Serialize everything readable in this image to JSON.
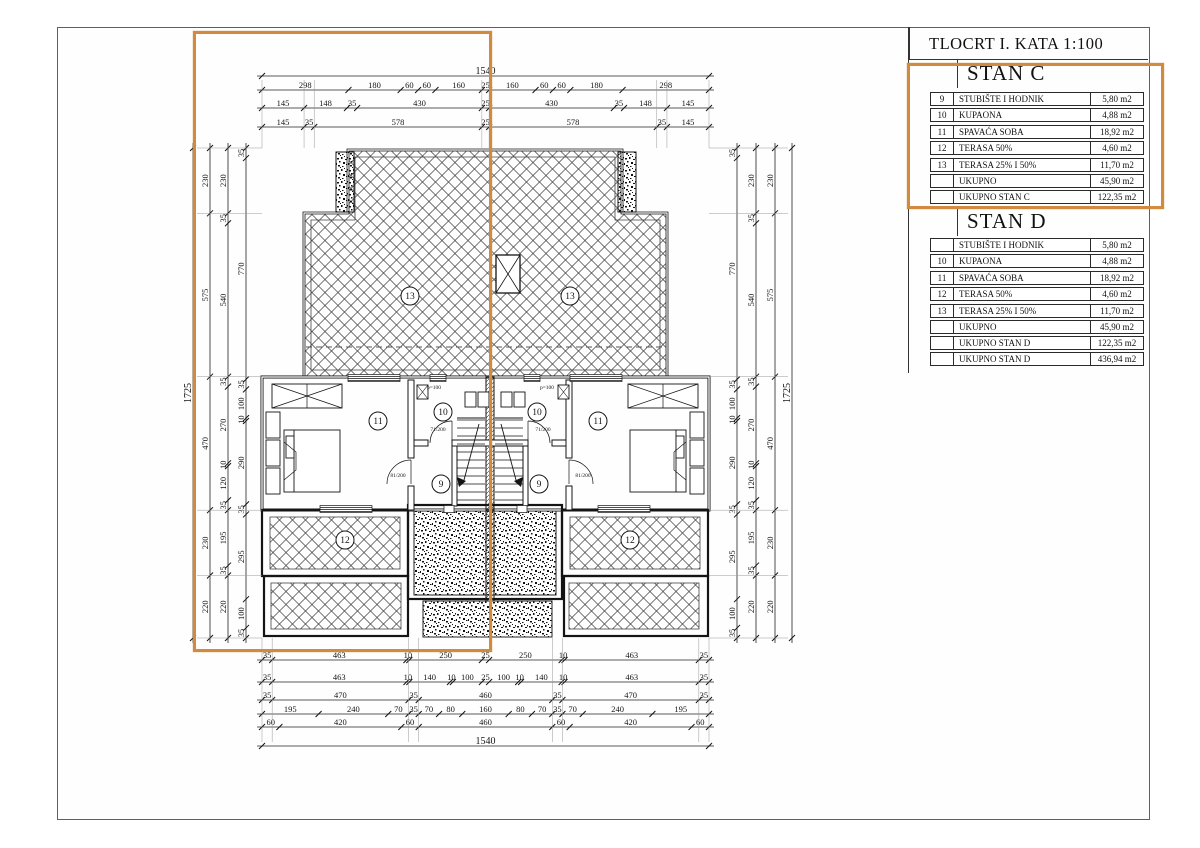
{
  "title": "TLOCRT I. KATA 1:100",
  "highlight_color": "#d28a3e",
  "tables": {
    "stan_c": {
      "title": "STAN C",
      "rows": [
        [
          "9",
          "STUBIŠTE I HODNIK",
          "5,80 m2"
        ],
        [
          "10",
          "KUPAONA",
          "4,88 m2"
        ],
        [
          "11",
          "SPAVAĆA SOBA",
          "18,92 m2"
        ],
        [
          "12",
          "TERASA 50%",
          "4,60 m2"
        ],
        [
          "13",
          "TERASA 25% I 50%",
          "11,70 m2"
        ],
        [
          "",
          "UKUPNO",
          "45,90 m2"
        ],
        [
          "",
          "UKUPNO STAN C",
          "122,35 m2"
        ]
      ]
    },
    "stan_d": {
      "title": "STAN D",
      "rows": [
        [
          "",
          "STUBIŠTE I HODNIK",
          "5,80 m2"
        ],
        [
          "10",
          "KUPAONA",
          "4,88 m2"
        ],
        [
          "11",
          "SPAVAĆA SOBA",
          "18,92 m2"
        ],
        [
          "12",
          "TERASA 50%",
          "4,60 m2"
        ],
        [
          "13",
          "TERASA 25% I 50%",
          "11,70 m2"
        ],
        [
          "",
          "UKUPNO",
          "45,90 m2"
        ],
        [
          "",
          "UKUPNO STAN D",
          "122,35 m2"
        ]
      ]
    },
    "total": {
      "rows": [
        [
          "",
          "UKUPNO STAN D",
          "436,94 m2"
        ]
      ]
    }
  },
  "room_labels": [
    "9",
    "10",
    "11",
    "12",
    "13"
  ],
  "annotations": {
    "door_small": "71/200",
    "door_entry": "81/200",
    "parapet": "p=100"
  },
  "dims": {
    "top": {
      "total": "1540",
      "rows": [
        [
          "298",
          "180",
          "60",
          "60",
          "160",
          "25",
          "160",
          "60",
          "60",
          "180",
          "298"
        ],
        [
          "145",
          "148",
          "35",
          "430",
          "25",
          "430",
          "35",
          "148",
          "145"
        ],
        [
          "145",
          "35",
          "578",
          "25",
          "578",
          "35",
          "145"
        ]
      ]
    },
    "bottom": {
      "total": "1540",
      "rows": [
        [
          "35",
          "463",
          "10",
          "250",
          "25",
          "250",
          "10",
          "463",
          "35"
        ],
        [
          "35",
          "463",
          "10",
          "140",
          "10",
          "100",
          "25",
          "100",
          "10",
          "140",
          "10",
          "463",
          "35"
        ],
        [
          "35",
          "470",
          "35",
          "460",
          "35",
          "470",
          "35"
        ],
        [
          "195",
          "240",
          "70",
          "35",
          "70",
          "80",
          "160",
          "80",
          "70",
          "35",
          "70",
          "240",
          "195"
        ],
        [
          "60",
          "420",
          "60",
          "460",
          "60",
          "420",
          "60"
        ]
      ]
    },
    "left": {
      "total": "1725",
      "rows": [
        [
          "35",
          "770",
          "35",
          "100",
          "10",
          "290",
          "35",
          "295",
          "100",
          "35"
        ],
        [
          "230",
          "35",
          "540",
          "35",
          "270",
          "10",
          "120",
          "35",
          "195",
          "35",
          "220"
        ],
        [
          "230",
          "575",
          "470",
          "230",
          "220"
        ]
      ]
    },
    "right": {
      "total": "1725",
      "rows": [
        [
          "35",
          "770",
          "35",
          "100",
          "10",
          "290",
          "35",
          "295",
          "100",
          "35"
        ],
        [
          "230",
          "35",
          "540",
          "35",
          "270",
          "10",
          "120",
          "35",
          "195",
          "35",
          "220"
        ],
        [
          "230",
          "575",
          "470",
          "230",
          "220"
        ]
      ]
    }
  }
}
